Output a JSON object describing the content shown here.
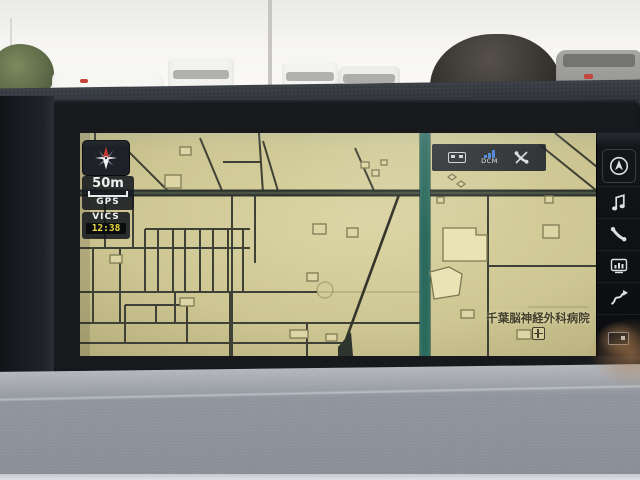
{
  "nav": {
    "compass_icon": "compass-north-icon",
    "scale_label": "50m",
    "gps_label": "GPS",
    "vics_label": "VICS",
    "vics_time": "12:38",
    "status_bar": {
      "dcm_label": "DCM",
      "icons": [
        "media-source-icon",
        "dcm-signal-icon",
        "phone-disabled-icon"
      ]
    },
    "poi_label": "千葉脳神経外科病院",
    "poi_icon": "hospital-icon",
    "sidebar_icons": [
      "current-location-icon",
      "music-note-icon",
      "phone-icon",
      "vehicle-info-icon",
      "route-icon",
      "display-off-icon"
    ]
  },
  "colors": {
    "map_background": "#cdc692",
    "road": "#3f4136",
    "highlighted_road": "#2c6a5e",
    "building_fill": "#ddd6a4",
    "vics_time_accent": "#ead83f",
    "dcm_signal": "#4d86d6",
    "screen_bezel": "#17191d",
    "dashboard_lower": "#9399a1"
  }
}
